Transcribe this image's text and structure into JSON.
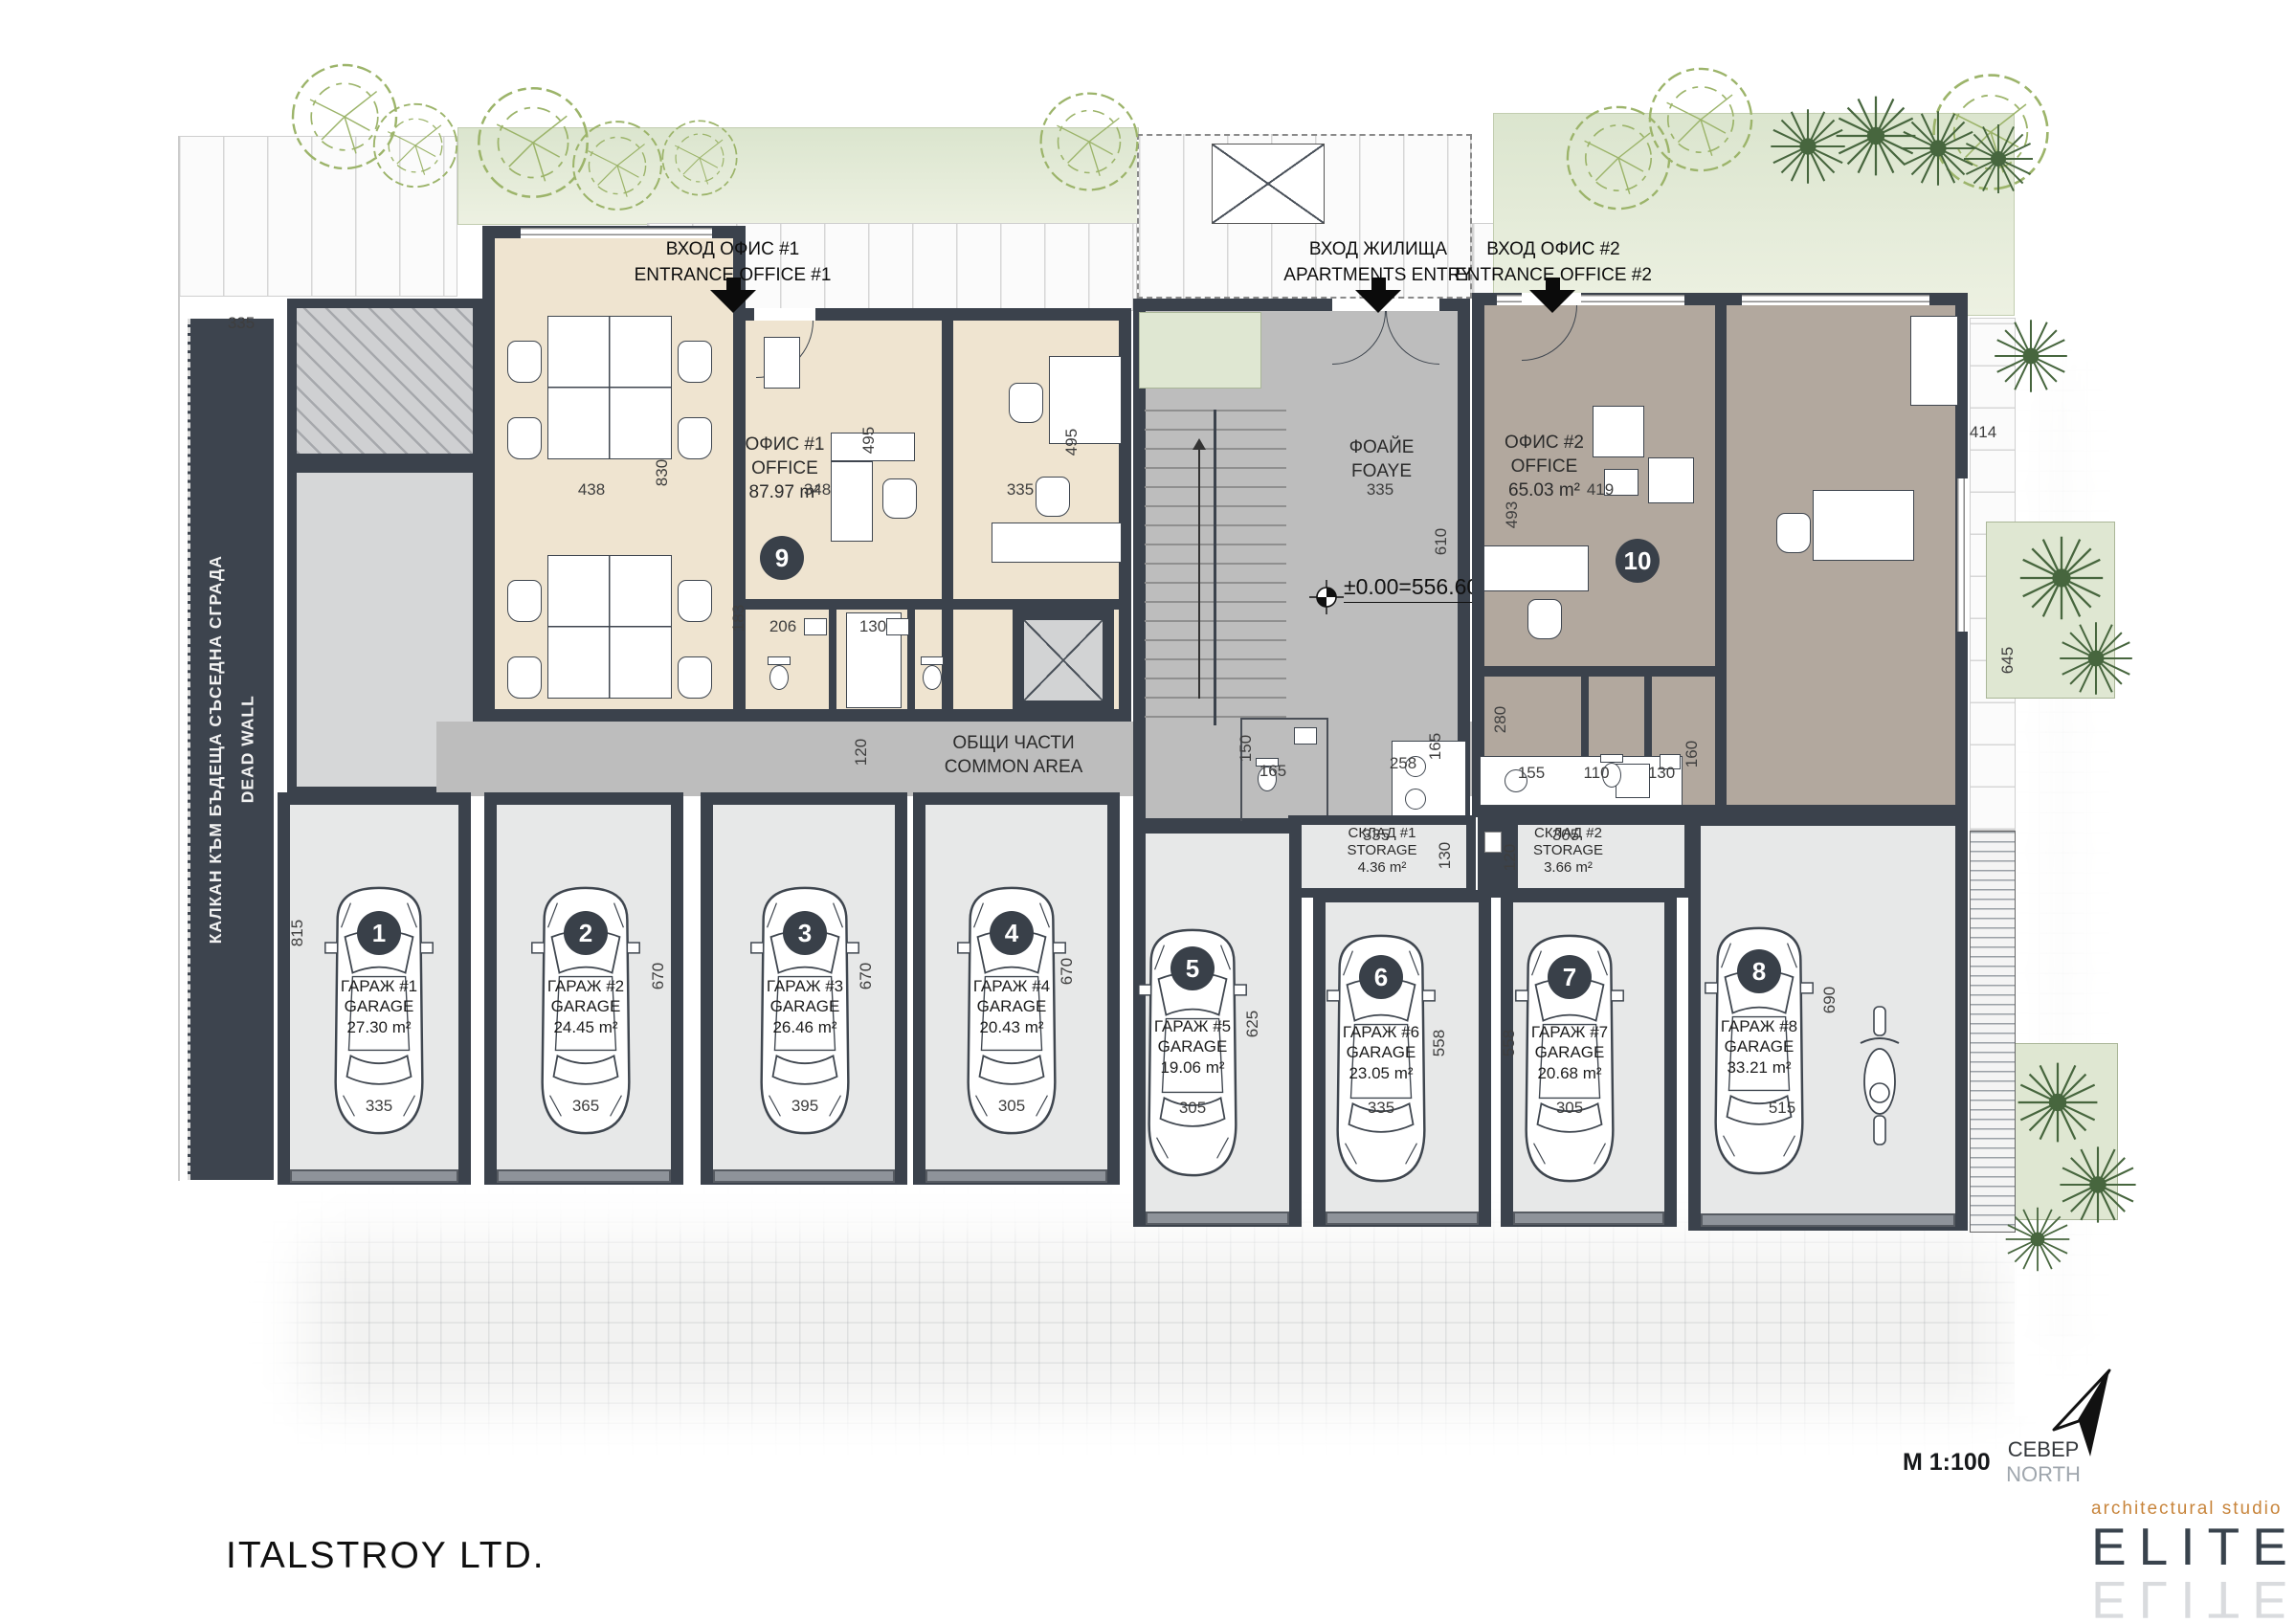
{
  "plan": {
    "company": "ITALSTROY LTD.",
    "scale": "M 1:100",
    "north": {
      "bg": "СЕВЕР",
      "en": "NORTH"
    },
    "level_mark": "±0.00=556.60",
    "logo": {
      "studio": "architectural studio",
      "name": "ELITE"
    },
    "dead_wall": {
      "bg": "КАЛКАН КЪМ БЪДЕЩА СЪСЕДНА СГРАДА",
      "en": "DEAD WALL"
    },
    "entrances": [
      {
        "bg": "ВХОД ОФИС #1",
        "en": "ENTRANCE OFFICE #1"
      },
      {
        "bg": "ВХОД ЖИЛИЩА",
        "en": "APARTMENTS ENTRY"
      },
      {
        "bg": "ВХОД ОФИС #2",
        "en": "ENTRANCE OFFICE #2"
      }
    ],
    "rooms": {
      "office1": {
        "bg": "ОФИС #1",
        "en": "OFFICE",
        "area": "87.97 m²",
        "badge": "9"
      },
      "office2": {
        "bg": "ОФИС #2",
        "en": "OFFICE",
        "area": "65.03 m²",
        "badge": "10"
      },
      "foyer": {
        "bg": "ФОАЙЕ",
        "en": "FOAYE"
      },
      "common": {
        "bg": "ОБЩИ ЧАСТИ",
        "en": "COMMON AREA"
      },
      "storage1": {
        "bg": "СКЛАД #1",
        "en": "STORAGE",
        "area": "4.36 m²"
      },
      "storage2": {
        "bg": "СКЛАД #2",
        "en": "STORAGE",
        "area": "3.66 m²"
      }
    },
    "garages": [
      {
        "badge": "1",
        "bg": "ГАРАЖ #1",
        "en": "GARAGE",
        "area": "27.30 m²",
        "w": "335",
        "d": "815"
      },
      {
        "badge": "2",
        "bg": "ГАРАЖ #2",
        "en": "GARAGE",
        "area": "24.45 m²",
        "w": "365",
        "d": "670"
      },
      {
        "badge": "3",
        "bg": "ГАРАЖ #3",
        "en": "GARAGE",
        "area": "26.46 m²",
        "w": "395",
        "d": "670"
      },
      {
        "badge": "4",
        "bg": "ГАРАЖ #4",
        "en": "GARAGE",
        "area": "20.43 m²",
        "w": "305",
        "d": "670"
      },
      {
        "badge": "5",
        "bg": "ГАРАЖ #5",
        "en": "GARAGE",
        "area": "19.06 m²",
        "w": "305",
        "d": "625"
      },
      {
        "badge": "6",
        "bg": "ГАРАЖ #6",
        "en": "GARAGE",
        "area": "23.05 m²",
        "w": "335",
        "d": "558"
      },
      {
        "badge": "7",
        "bg": "ГАРАЖ #7",
        "en": "GARAGE",
        "area": "20.68 m²",
        "w": "305",
        "d": "558"
      },
      {
        "badge": "8",
        "bg": "ГАРАЖ #8",
        "en": "GARAGE",
        "area": "33.21 m²",
        "w": "515",
        "d": "690"
      }
    ],
    "dims": {
      "d438": "438",
      "d830": "830",
      "d348": "348",
      "o1w3": "335",
      "o1h2": "495",
      "o1h3": "495",
      "fw": "335",
      "fh": "610",
      "o2w1": "419",
      "o2h1": "493",
      "o2w2": "414",
      "o2h2": "645",
      "o2h3": "280",
      "b1": "183",
      "b2": "206",
      "b3": "130",
      "corr": "120",
      "wc1": "150",
      "wc2": "165",
      "wc3": "258",
      "wc4": "165",
      "k1": "155",
      "k2": "110",
      "k3": "130",
      "k4": "160",
      "s1w": "335",
      "s1h": "130",
      "s2w": "305",
      "s2h": "120",
      "annex": "335"
    },
    "icons": {
      "north_arrow": "north-arrow",
      "level_marker": "level-marker",
      "car": "car-top-view",
      "motorcycle": "motorcycle-top-view",
      "tree_deciduous": "tree-outline",
      "tree_conifer": "tree-conifer"
    },
    "colors": {
      "wall": "#3b424c",
      "office1_floor": "#efe4d0",
      "office2_floor": "#b2a89e",
      "circulation_floor": "#bdbdbd",
      "garage_floor": "#e7e8e8",
      "landscape": "#dfe8d3",
      "badge": "#394049",
      "logo_accent": "#c8853c"
    }
  }
}
